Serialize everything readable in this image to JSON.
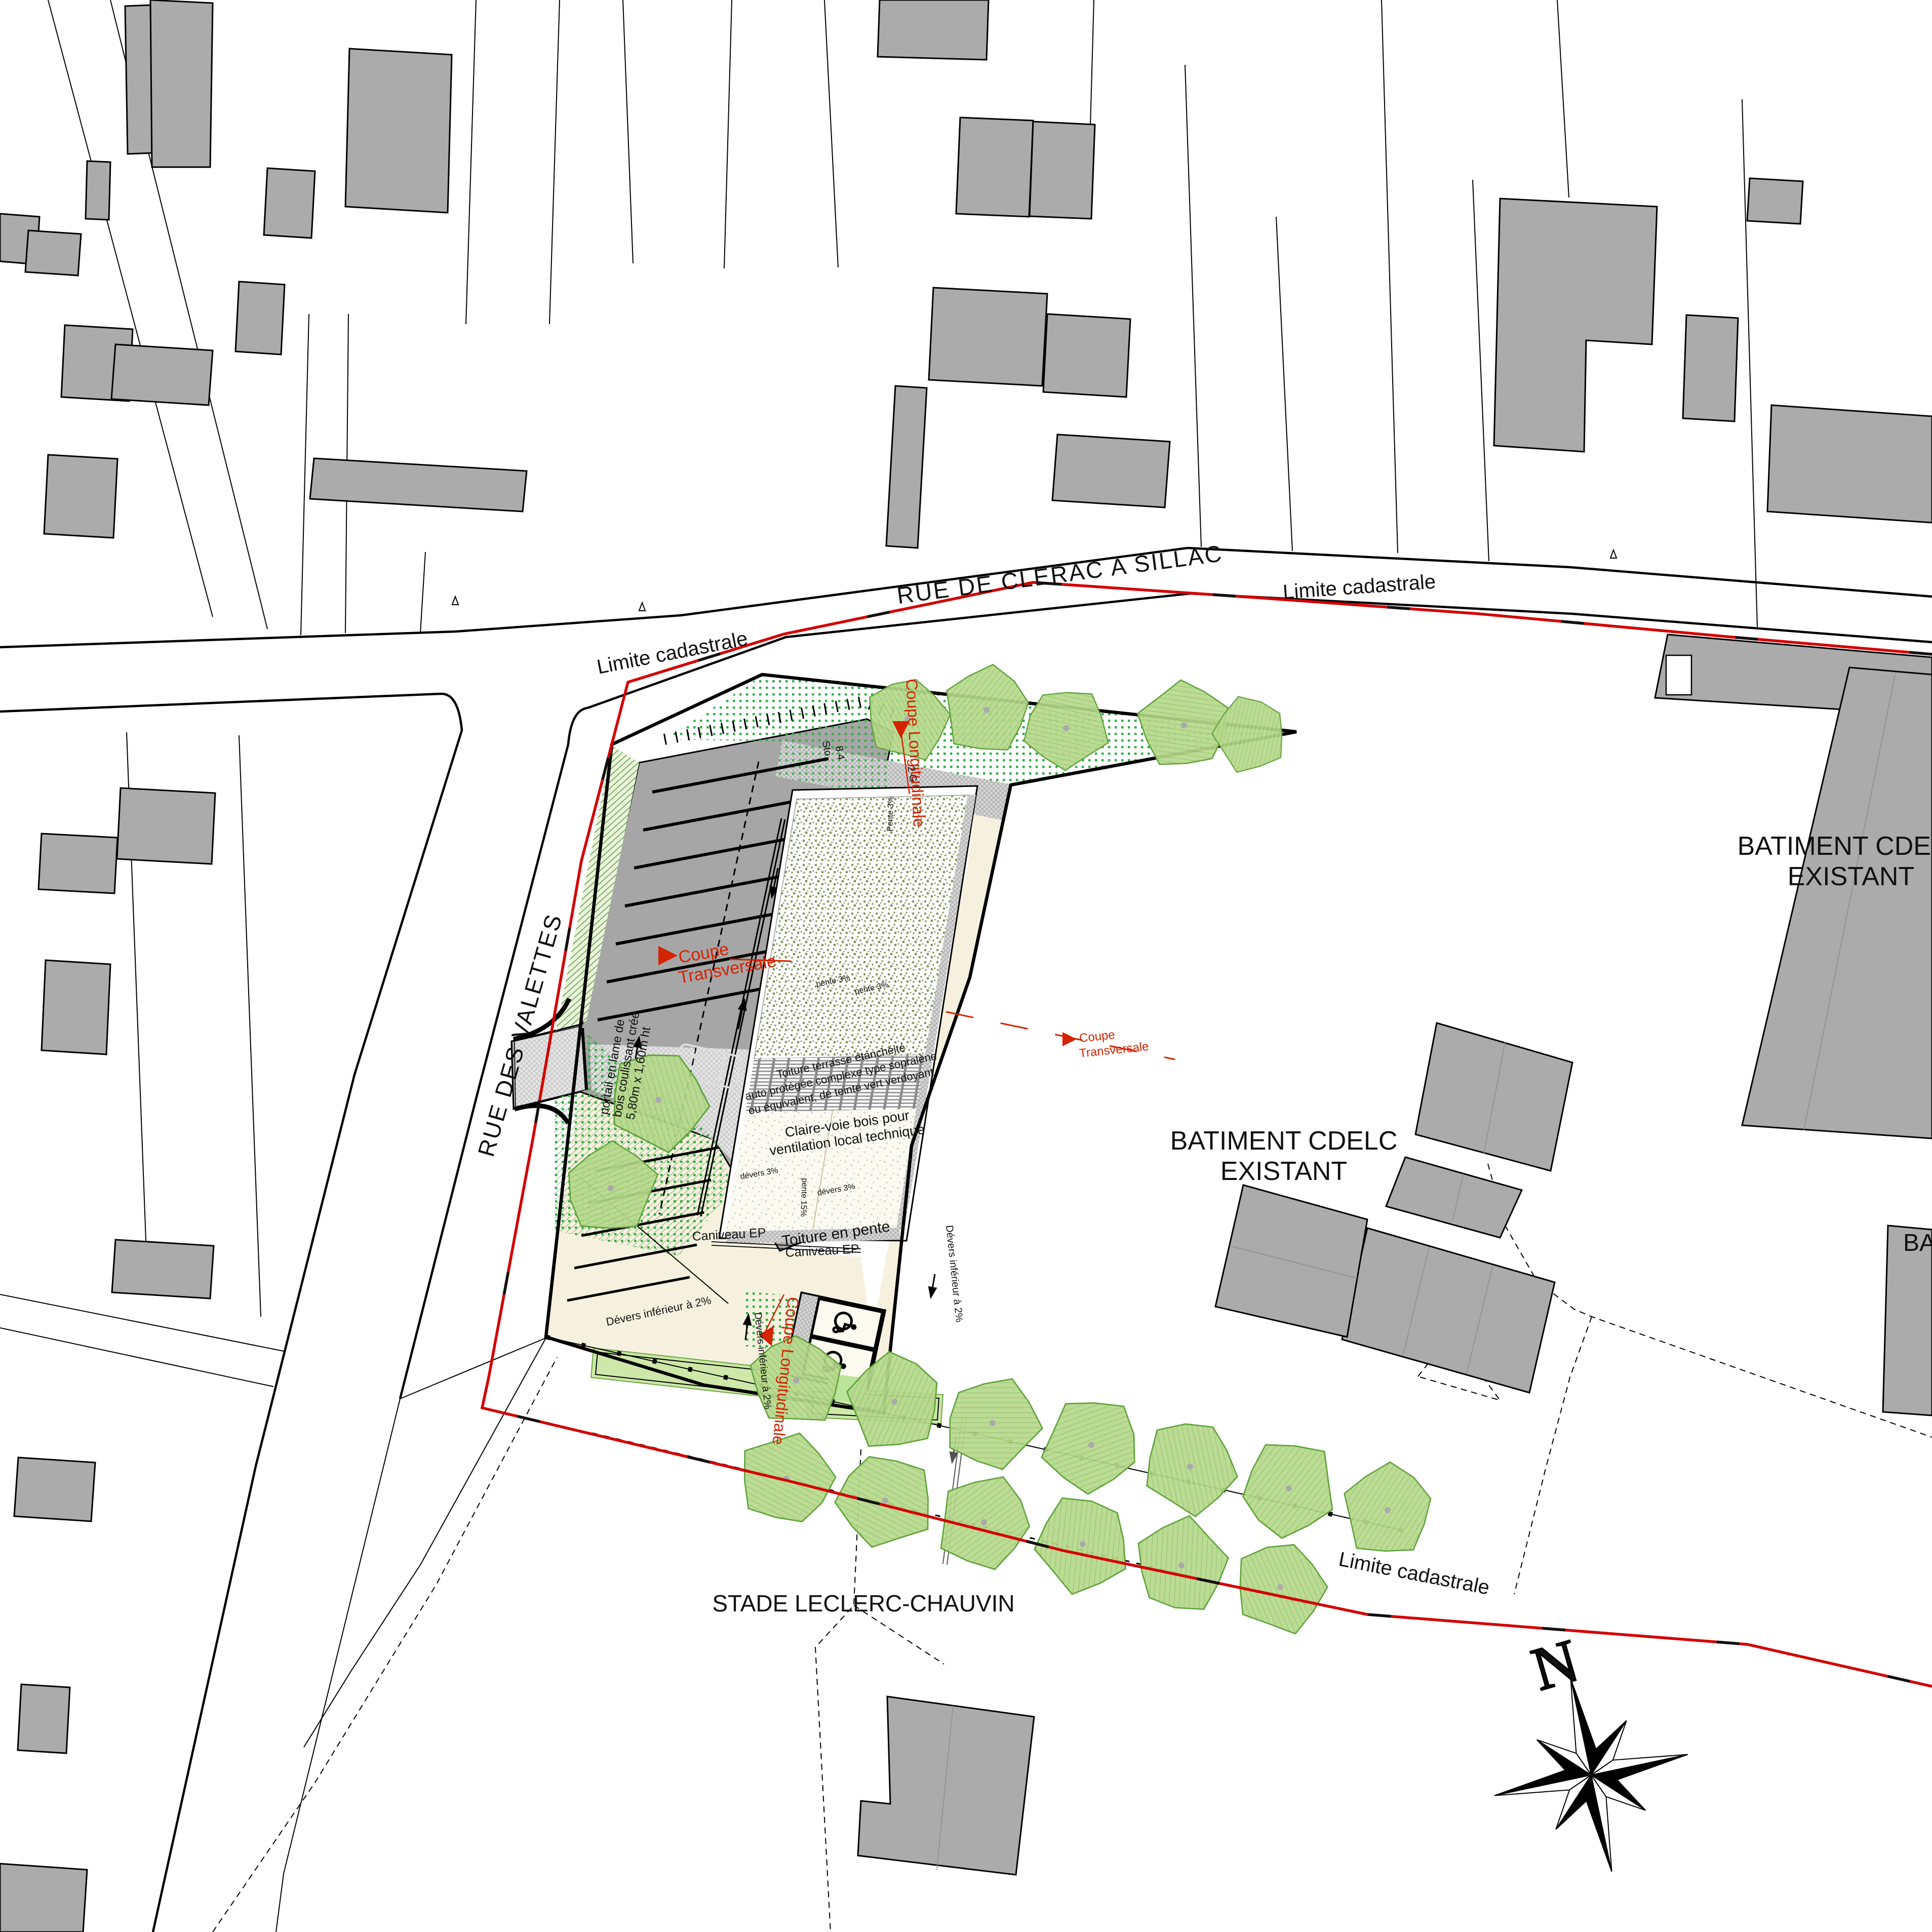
{
  "streets": {
    "rue_clerac": "RUE DE CLERAC A SILLAC",
    "rue_valettes": "RUE DES VALETTES"
  },
  "cadastre": {
    "limite": "Limite cadastrale"
  },
  "places": {
    "stade": "STADE LECLERC-CHAUVIN",
    "batiment_line1": "BATIMENT CDELC",
    "batiment_line2": "EXISTANT",
    "batiment_partial": "BA"
  },
  "sections": {
    "coupe": "Coupe",
    "transversale": "Transversale",
    "longitudinale": "Coupe Longitudinale"
  },
  "annotations": {
    "portail_l1": "portail en lame de",
    "portail_l2": "bois coulissant créé",
    "portail_l3": "5,80m x 1,60m ht",
    "caniveau": "Caniveau EP",
    "claire_l1": "Claire-voie bois pour",
    "claire_l2": "ventilation local technique",
    "toiture_pente": "Toiture en pente",
    "toiture_l1": "Toiture terrasse étanchéité",
    "toiture_l2": "auto protégée complexe type sopralène",
    "toiture_l3": "ou équivalent, de teinte vert verdoyant",
    "devers3": "dévers 3%",
    "pente15": "pente 15%",
    "pente3": "pente 3%",
    "pente3_cap": "Pente 3%",
    "devers_inf": "Dévers inférieur à 2%",
    "sto": "Sto",
    "v84": "8.4",
    "v2g": "2 G"
  },
  "compass": {
    "north": "N"
  },
  "colors": {
    "cadastral_red": "#d40000",
    "section_red": "#d42300",
    "building_gray": "#ababab",
    "asphalt_gray": "#a6a6a6",
    "cream": "#f6f1de",
    "tree_green": "#b7d88c",
    "dot_green": "#2fae47",
    "roof_olive": "#7d9455",
    "planter_green": "#cde8a9"
  }
}
